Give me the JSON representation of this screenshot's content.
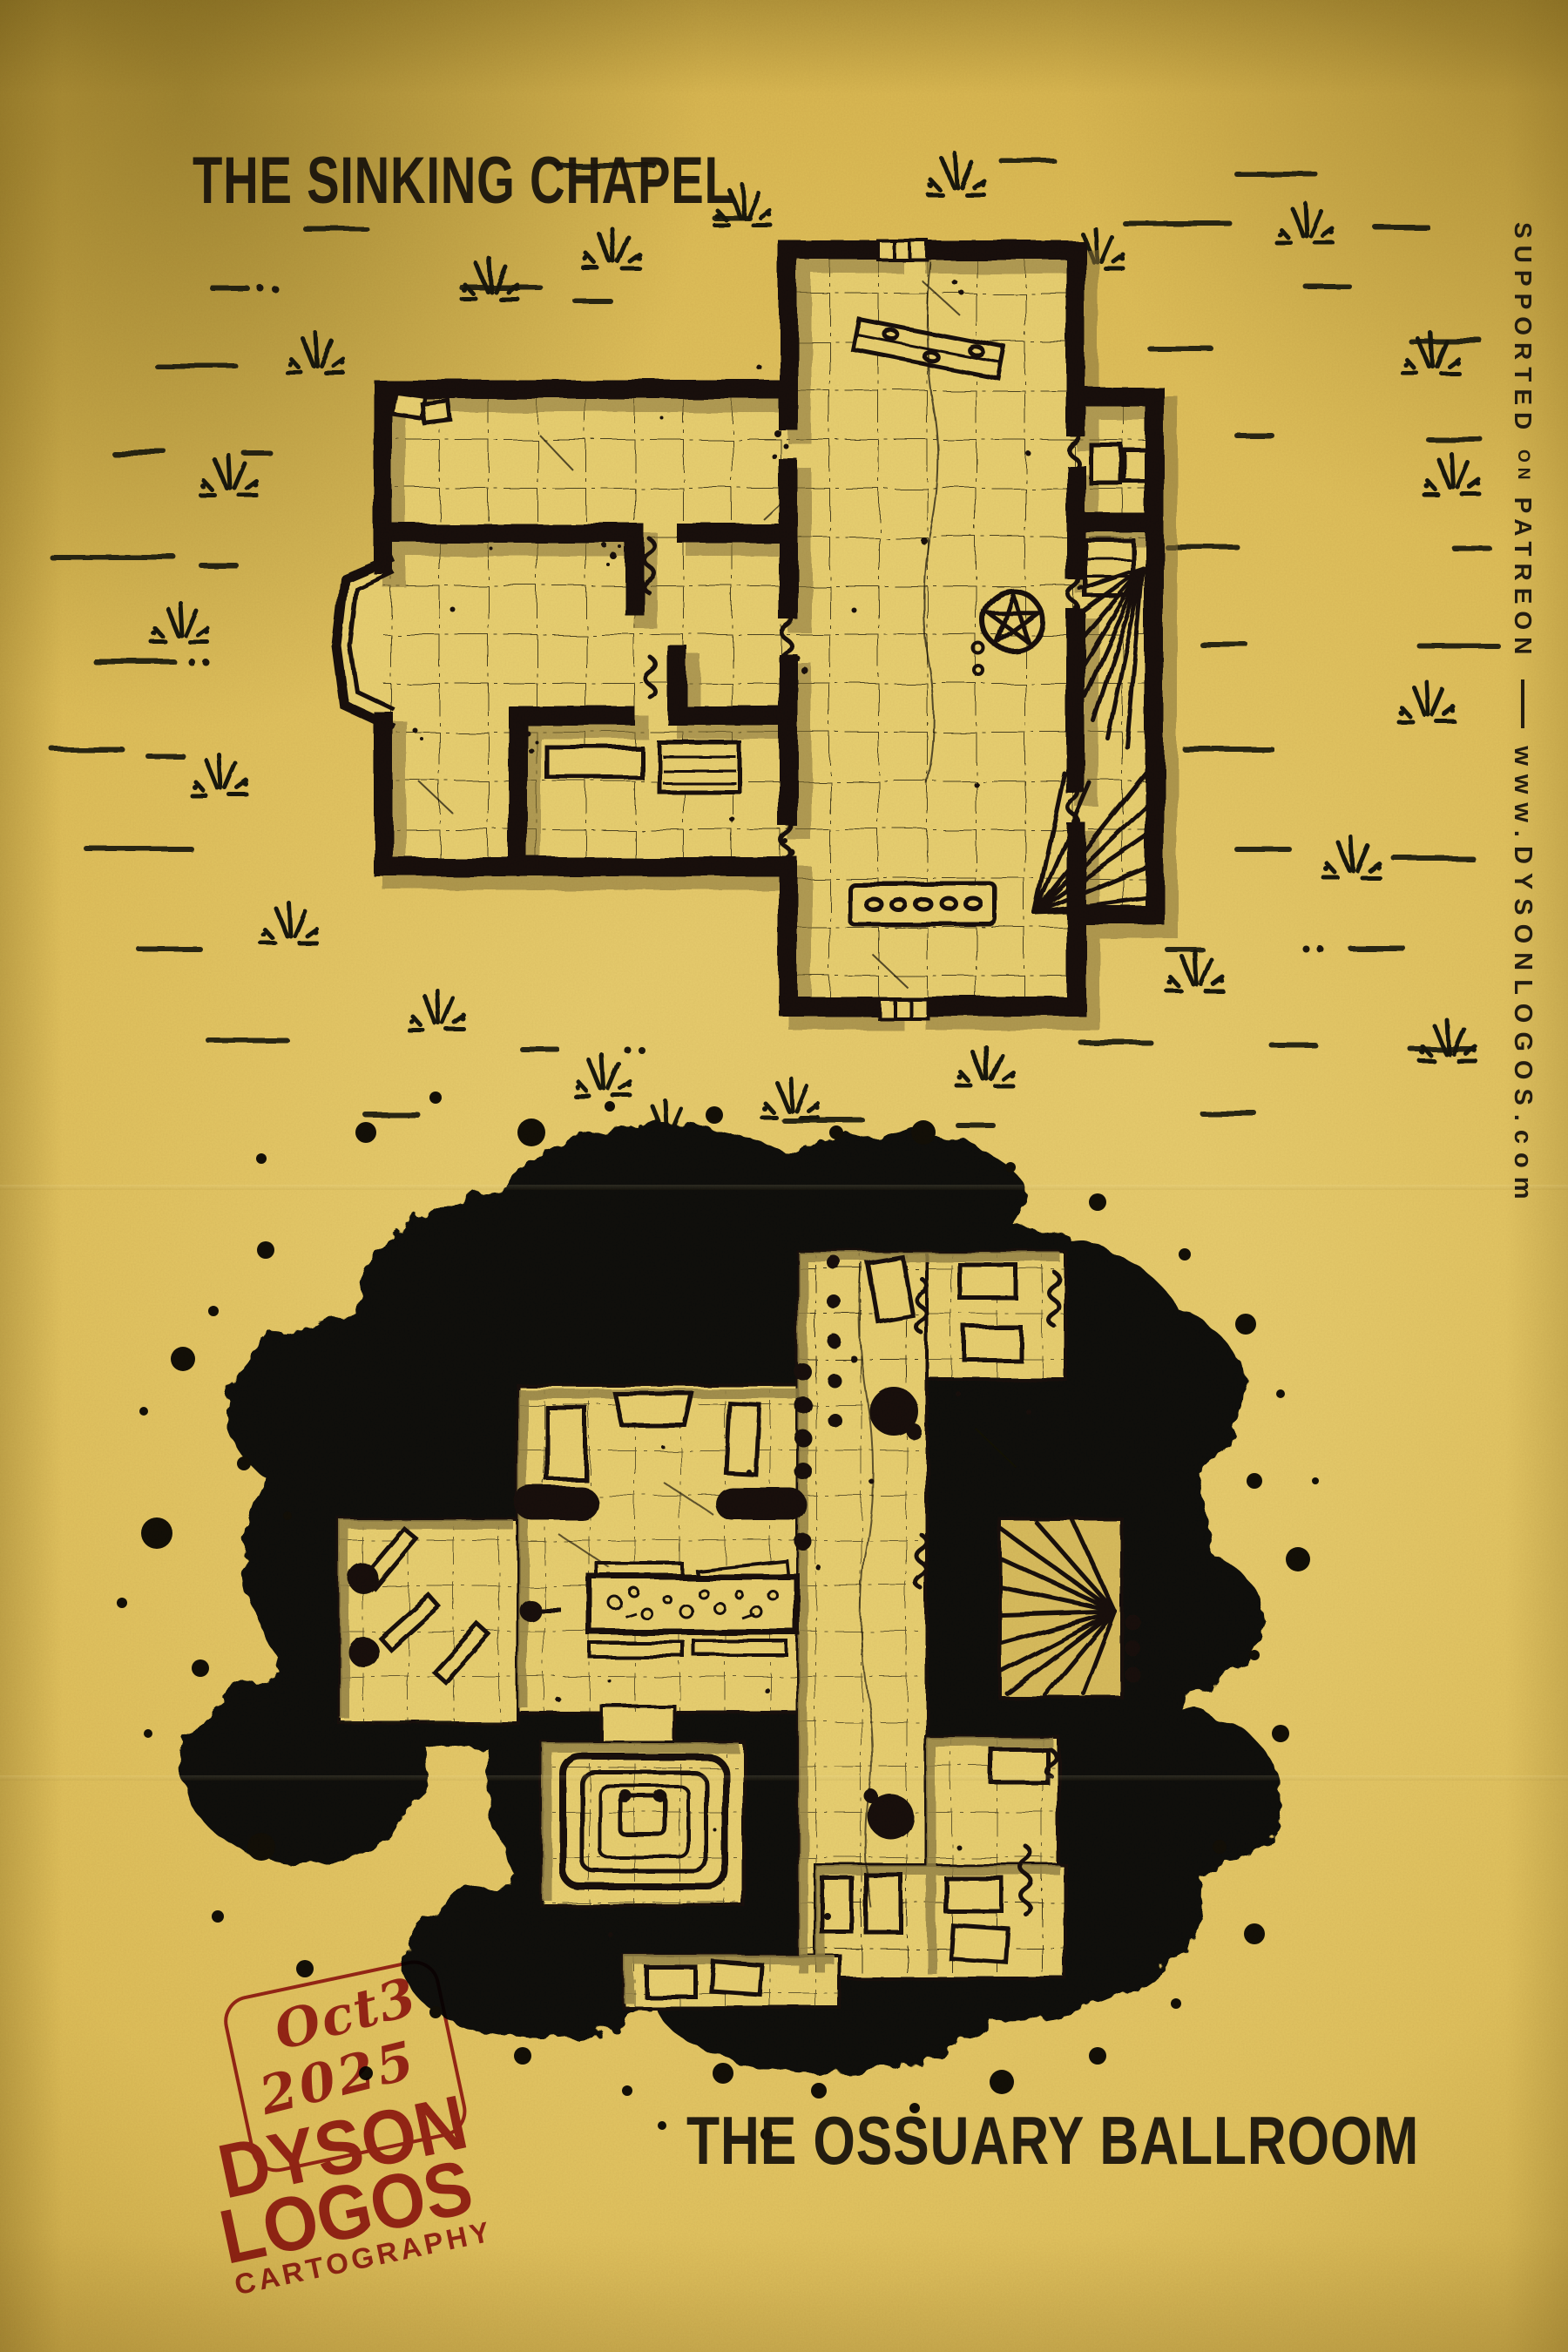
{
  "titles": {
    "top": "THE SINKING CHAPEL",
    "bottom": "THE OSSUARY BALLROOM"
  },
  "sidebar": {
    "supported": "SUPPORTED",
    "on": "ON",
    "patreon": "PATREON",
    "website": "www.DYSONLOGOS.com"
  },
  "stamp": {
    "date_month": "Oct3",
    "date_year": "2025",
    "name_line1": "DYSON",
    "name_line2": "LOGOS",
    "tagline": "CARTOGRAPHY"
  },
  "maps": [
    {
      "id": "sinking-chapel",
      "title": "The Sinking Chapel",
      "features": [
        "chapel hall",
        "nave",
        "apse bay",
        "side rooms",
        "spiral staircase",
        "magic circle",
        "pews",
        "collapsed doorways",
        "grass field"
      ]
    },
    {
      "id": "ossuary-ballroom",
      "title": "The Ossuary Ballroom",
      "features": [
        "ink splatter cavern",
        "pillared hall",
        "ballroom",
        "bone table",
        "dais with throne",
        "caskets",
        "spiral staircase",
        "side crypts"
      ]
    }
  ],
  "colors": {
    "paper": "#e3c261",
    "floor": "#ead173",
    "ink": "#14100a",
    "shadow": "#97854a",
    "stamp_red": "#a3242b"
  }
}
